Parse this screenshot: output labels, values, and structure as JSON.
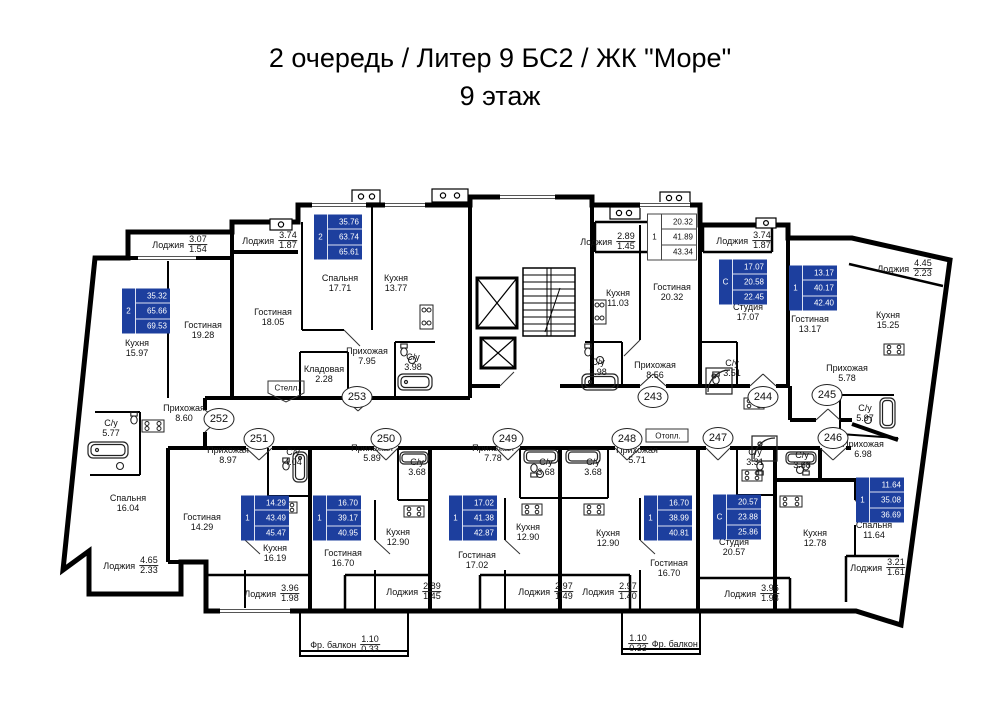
{
  "title": {
    "line1": "2 очередь / Литер 9 БС2 / ЖК \"Море\"",
    "line2": "9 этаж"
  },
  "colors": {
    "available_box_bg": "#1d3f9e",
    "available_box_text": "#ffffff",
    "alt_box_bg": "#ffffff",
    "alt_box_text": "#111111",
    "walls": "#000000"
  },
  "plan": {
    "units": [
      {
        "number": "252",
        "circle": {
          "x": 219,
          "y": 419
        },
        "box": {
          "x": 146,
          "y": 311,
          "style": "blue",
          "rooms": "2",
          "v1": "35.32",
          "v2": "65.66",
          "v3": "69.53"
        }
      },
      {
        "number": "253",
        "circle": {
          "x": 357,
          "y": 397
        },
        "box": {
          "x": 338,
          "y": 237,
          "style": "blue",
          "rooms": "2",
          "v1": "35.76",
          "v2": "63.74",
          "v3": "65.61"
        }
      },
      {
        "number": "243",
        "circle": {
          "x": 653,
          "y": 397
        },
        "box": {
          "x": 672,
          "y": 237,
          "style": "white",
          "rooms": "1",
          "v1": "20.32",
          "v2": "41.89",
          "v3": "43.34"
        }
      },
      {
        "number": "244",
        "circle": {
          "x": 763,
          "y": 397
        },
        "box": {
          "x": 743,
          "y": 282,
          "style": "blue",
          "rooms": "С",
          "v1": "17.07",
          "v2": "20.58",
          "v3": "22.45"
        }
      },
      {
        "number": "245",
        "circle": {
          "x": 827,
          "y": 395
        },
        "box": {
          "x": 813,
          "y": 288,
          "style": "blue",
          "rooms": "1",
          "v1": "13.17",
          "v2": "40.17",
          "v3": "42.40"
        }
      },
      {
        "number": "246",
        "circle": {
          "x": 833,
          "y": 438
        },
        "box": {
          "x": 880,
          "y": 500,
          "style": "blue",
          "rooms": "1",
          "v1": "11.64",
          "v2": "35.08",
          "v3": "36.69"
        }
      },
      {
        "number": "247",
        "circle": {
          "x": 718,
          "y": 438
        },
        "box": {
          "x": 737,
          "y": 517,
          "style": "blue",
          "rooms": "С",
          "v1": "20.57",
          "v2": "23.88",
          "v3": "25.86"
        }
      },
      {
        "number": "248",
        "circle": {
          "x": 627,
          "y": 439
        },
        "box": {
          "x": 668,
          "y": 518,
          "style": "blue",
          "rooms": "1",
          "v1": "16.70",
          "v2": "38.99",
          "v3": "40.81"
        }
      },
      {
        "number": "249",
        "circle": {
          "x": 508,
          "y": 439
        },
        "box": {
          "x": 473,
          "y": 518,
          "style": "blue",
          "rooms": "1",
          "v1": "17.02",
          "v2": "41.38",
          "v3": "42.87"
        }
      },
      {
        "number": "250",
        "circle": {
          "x": 386,
          "y": 439
        },
        "box": {
          "x": 337,
          "y": 518,
          "style": "blue",
          "rooms": "1",
          "v1": "16.70",
          "v2": "39.17",
          "v3": "40.95"
        }
      },
      {
        "number": "251",
        "circle": {
          "x": 259,
          "y": 439
        },
        "box": {
          "x": 265,
          "y": 518,
          "style": "blue",
          "rooms": "1",
          "v1": "14.29",
          "v2": "43.49",
          "v3": "45.47"
        }
      }
    ],
    "rooms": [
      {
        "unit": "252",
        "name": "Кухня",
        "area": "15.97",
        "x": 137,
        "y": 348
      },
      {
        "unit": "252",
        "name": "Гостиная",
        "area": "19.28",
        "x": 203,
        "y": 330
      },
      {
        "unit": "252",
        "name": "Прихожая",
        "area": "8.60",
        "x": 184,
        "y": 413
      },
      {
        "unit": "252",
        "name": "С/у",
        "area": "5.77",
        "x": 111,
        "y": 428
      },
      {
        "unit": "252",
        "name": "Спальня",
        "area": "16.04",
        "x": 128,
        "y": 503
      },
      {
        "unit": "253",
        "name": "Спальня",
        "area": "17.71",
        "x": 340,
        "y": 283
      },
      {
        "unit": "253",
        "name": "Кухня",
        "area": "13.77",
        "x": 396,
        "y": 283
      },
      {
        "unit": "253",
        "name": "Гостиная",
        "area": "18.05",
        "x": 273,
        "y": 317
      },
      {
        "unit": "253",
        "name": "Прихожая",
        "area": "7.95",
        "x": 367,
        "y": 356
      },
      {
        "unit": "253",
        "name": "Кладовая",
        "area": "2.28",
        "x": 324,
        "y": 374
      },
      {
        "unit": "253",
        "name": "С/у",
        "area": "3.98",
        "x": 413,
        "y": 362
      },
      {
        "unit": "243",
        "name": "Кухня",
        "area": "11.03",
        "x": 618,
        "y": 298
      },
      {
        "unit": "243",
        "name": "Гостиная",
        "area": "20.32",
        "x": 672,
        "y": 292
      },
      {
        "unit": "243",
        "name": "Прихожая",
        "area": "8.56",
        "x": 655,
        "y": 370
      },
      {
        "unit": "243",
        "name": "С/у",
        "area": "3.98",
        "x": 598,
        "y": 367
      },
      {
        "unit": "244",
        "name": "Студия",
        "area": "17.07",
        "x": 748,
        "y": 312
      },
      {
        "unit": "244",
        "name": "С/у",
        "area": "3.51",
        "x": 732,
        "y": 368
      },
      {
        "unit": "245",
        "name": "Гостиная",
        "area": "13.17",
        "x": 810,
        "y": 324
      },
      {
        "unit": "245",
        "name": "Кухня",
        "area": "15.25",
        "x": 888,
        "y": 320
      },
      {
        "unit": "245",
        "name": "Прихожая",
        "area": "5.78",
        "x": 847,
        "y": 373
      },
      {
        "unit": "245",
        "name": "С/у",
        "area": "5.97",
        "x": 865,
        "y": 413
      },
      {
        "unit": "246",
        "name": "Прихожая",
        "area": "6.98",
        "x": 863,
        "y": 449
      },
      {
        "unit": "246",
        "name": "С/у",
        "area": "3.68",
        "x": 802,
        "y": 460
      },
      {
        "unit": "246",
        "name": "Кухня",
        "area": "12.78",
        "x": 815,
        "y": 538
      },
      {
        "unit": "246",
        "name": "Спальня",
        "area": "11.64",
        "x": 874,
        "y": 530
      },
      {
        "unit": "247",
        "name": "С/у",
        "area": "3.31",
        "x": 755,
        "y": 457
      },
      {
        "unit": "247",
        "name": "Студия",
        "area": "20.57",
        "x": 734,
        "y": 547
      },
      {
        "unit": "248",
        "name": "Прихожая",
        "area": "5.71",
        "x": 637,
        "y": 455
      },
      {
        "unit": "248",
        "name": "С/у",
        "area": "3.68",
        "x": 593,
        "y": 467
      },
      {
        "unit": "248",
        "name": "Кухня",
        "area": "12.90",
        "x": 608,
        "y": 538
      },
      {
        "unit": "248",
        "name": "Гостиная",
        "area": "16.70",
        "x": 669,
        "y": 568
      },
      {
        "unit": "249",
        "name": "Прихожая",
        "area": "7.78",
        "x": 493,
        "y": 453
      },
      {
        "unit": "249",
        "name": "С/у",
        "area": "3.68",
        "x": 546,
        "y": 467
      },
      {
        "unit": "249",
        "name": "Кухня",
        "area": "12.90",
        "x": 528,
        "y": 532
      },
      {
        "unit": "249",
        "name": "Гостиная",
        "area": "17.02",
        "x": 477,
        "y": 560
      },
      {
        "unit": "250",
        "name": "Прихожая",
        "area": "5.89",
        "x": 372,
        "y": 453
      },
      {
        "unit": "250",
        "name": "С/у",
        "area": "3.68",
        "x": 417,
        "y": 467
      },
      {
        "unit": "250",
        "name": "Кухня",
        "area": "12.90",
        "x": 398,
        "y": 537
      },
      {
        "unit": "250",
        "name": "Гостиная",
        "area": "16.70",
        "x": 343,
        "y": 558
      },
      {
        "unit": "251",
        "name": "Прихожая",
        "area": "8.97",
        "x": 228,
        "y": 455
      },
      {
        "unit": "251",
        "name": "С/у",
        "area": "4.04",
        "x": 293,
        "y": 457
      },
      {
        "unit": "251",
        "name": "Кухня",
        "area": "16.19",
        "x": 275,
        "y": 553
      },
      {
        "unit": "251",
        "name": "Гостиная",
        "area": "14.29",
        "x": 202,
        "y": 522
      }
    ],
    "fractions": [
      {
        "name": "Лоджия",
        "a": "3.07",
        "b": "1.54",
        "x": 180,
        "y": 245,
        "flip": false
      },
      {
        "name": "Лоджия",
        "a": "3.74",
        "b": "1.87",
        "x": 270,
        "y": 241,
        "flip": false
      },
      {
        "name": "Лоджия",
        "a": "2.89",
        "b": "1.45",
        "x": 608,
        "y": 242,
        "flip": false
      },
      {
        "name": "Лоджия",
        "a": "3.74",
        "b": "1.87",
        "x": 744,
        "y": 241,
        "flip": false
      },
      {
        "name": "Лоджия",
        "a": "4.45",
        "b": "2.23",
        "x": 905,
        "y": 269,
        "flip": false
      },
      {
        "name": "Лоджия",
        "a": "4.65",
        "b": "2.33",
        "x": 131,
        "y": 566,
        "flip": false
      },
      {
        "name": "Лоджия",
        "a": "3.96",
        "b": "1.98",
        "x": 272,
        "y": 594,
        "flip": false
      },
      {
        "name": "Лоджия",
        "a": "2.89",
        "b": "1.45",
        "x": 414,
        "y": 592,
        "flip": false
      },
      {
        "name": "Лоджия",
        "a": "2.97",
        "b": "1.49",
        "x": 546,
        "y": 592,
        "flip": false
      },
      {
        "name": "Лоджия",
        "a": "2.97",
        "b": "1.40",
        "x": 610,
        "y": 592,
        "flip": false
      },
      {
        "name": "Лоджия",
        "a": "3.96",
        "b": "1.98",
        "x": 752,
        "y": 594,
        "flip": false
      },
      {
        "name": "Лоджия",
        "a": "3.21",
        "b": "1.61",
        "x": 878,
        "y": 568,
        "flip": false
      },
      {
        "name": "Фр. балкон",
        "a": "1.10",
        "b": "0.33",
        "x": 345,
        "y": 645,
        "flip": false
      },
      {
        "name": "Фр. балкон",
        "a": "1.10",
        "b": "0.33",
        "x": 663,
        "y": 644,
        "flip": true
      }
    ],
    "notes": [
      {
        "text": "Стелл.",
        "x": 287,
        "y": 388
      },
      {
        "text": "Отопл.",
        "x": 668,
        "y": 436
      }
    ]
  }
}
